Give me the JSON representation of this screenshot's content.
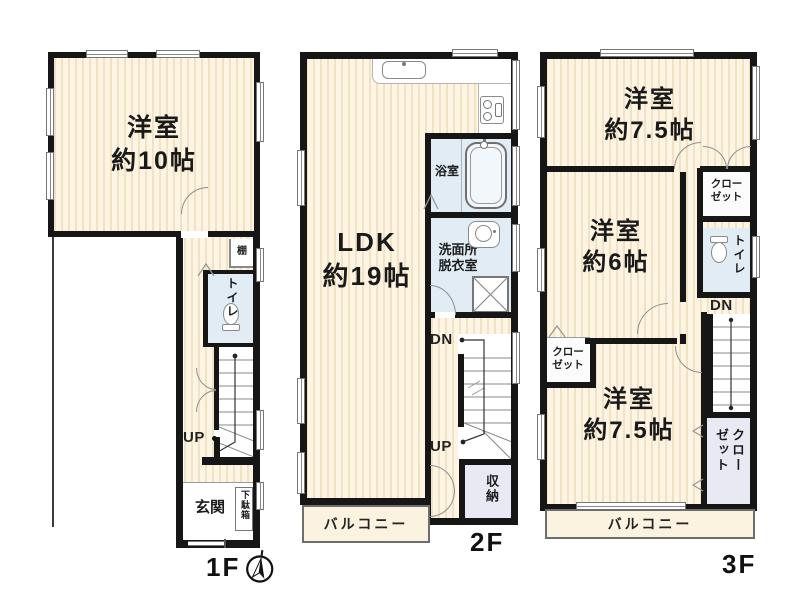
{
  "colors": {
    "wall": "#161616",
    "floor_base": "#fdf4e3",
    "floor_stripe": "#f2e2c4",
    "wet_area": "#e1ecf5",
    "closet": "#fbfbfb",
    "storage": "#e9e9f4",
    "balcony": "#fbf3e0"
  },
  "icons": {
    "compass": "compass-north-icon",
    "stairs": "stairs-icon",
    "bathtub": "bathtub-icon",
    "toilet": "toilet-icon",
    "sink": "sink-icon",
    "stove": "stove-icon",
    "washer": "washing-machine-icon",
    "kitchen_sink": "kitchen-sink-icon",
    "window": "window-symbol",
    "door": "door-arc"
  },
  "f1": {
    "floor_label": "1F",
    "room": {
      "name": "洋室",
      "size": "約10帖"
    },
    "shelf": "棚",
    "toilet": "トイレ",
    "up": "UP",
    "entrance": "玄関",
    "shoe_cabinet": "下駄箱"
  },
  "f2": {
    "floor_label": "2F",
    "ldk": {
      "name": "LDK",
      "size": "約19帖"
    },
    "bath": "浴室",
    "washroom": {
      "line1": "洗面所",
      "line2": "脱衣室"
    },
    "dn": "DN",
    "up": "UP",
    "storage": "収納",
    "balcony": "バルコニー"
  },
  "f3": {
    "floor_label": "3F",
    "room_top": {
      "name": "洋室",
      "size": "約7.5帖"
    },
    "room_mid": {
      "name": "洋室",
      "size": "約6帖"
    },
    "room_bottom": {
      "name": "洋室",
      "size": "約7.5帖"
    },
    "closet_top": {
      "line1": "クロー",
      "line2": "ゼット"
    },
    "closet_left": {
      "line1": "クロー",
      "line2": "ゼット"
    },
    "closet_right": {
      "line1": "クロー",
      "line2": "ゼット"
    },
    "toilet": "トイレ",
    "dn": "DN",
    "balcony": "バルコニー"
  }
}
